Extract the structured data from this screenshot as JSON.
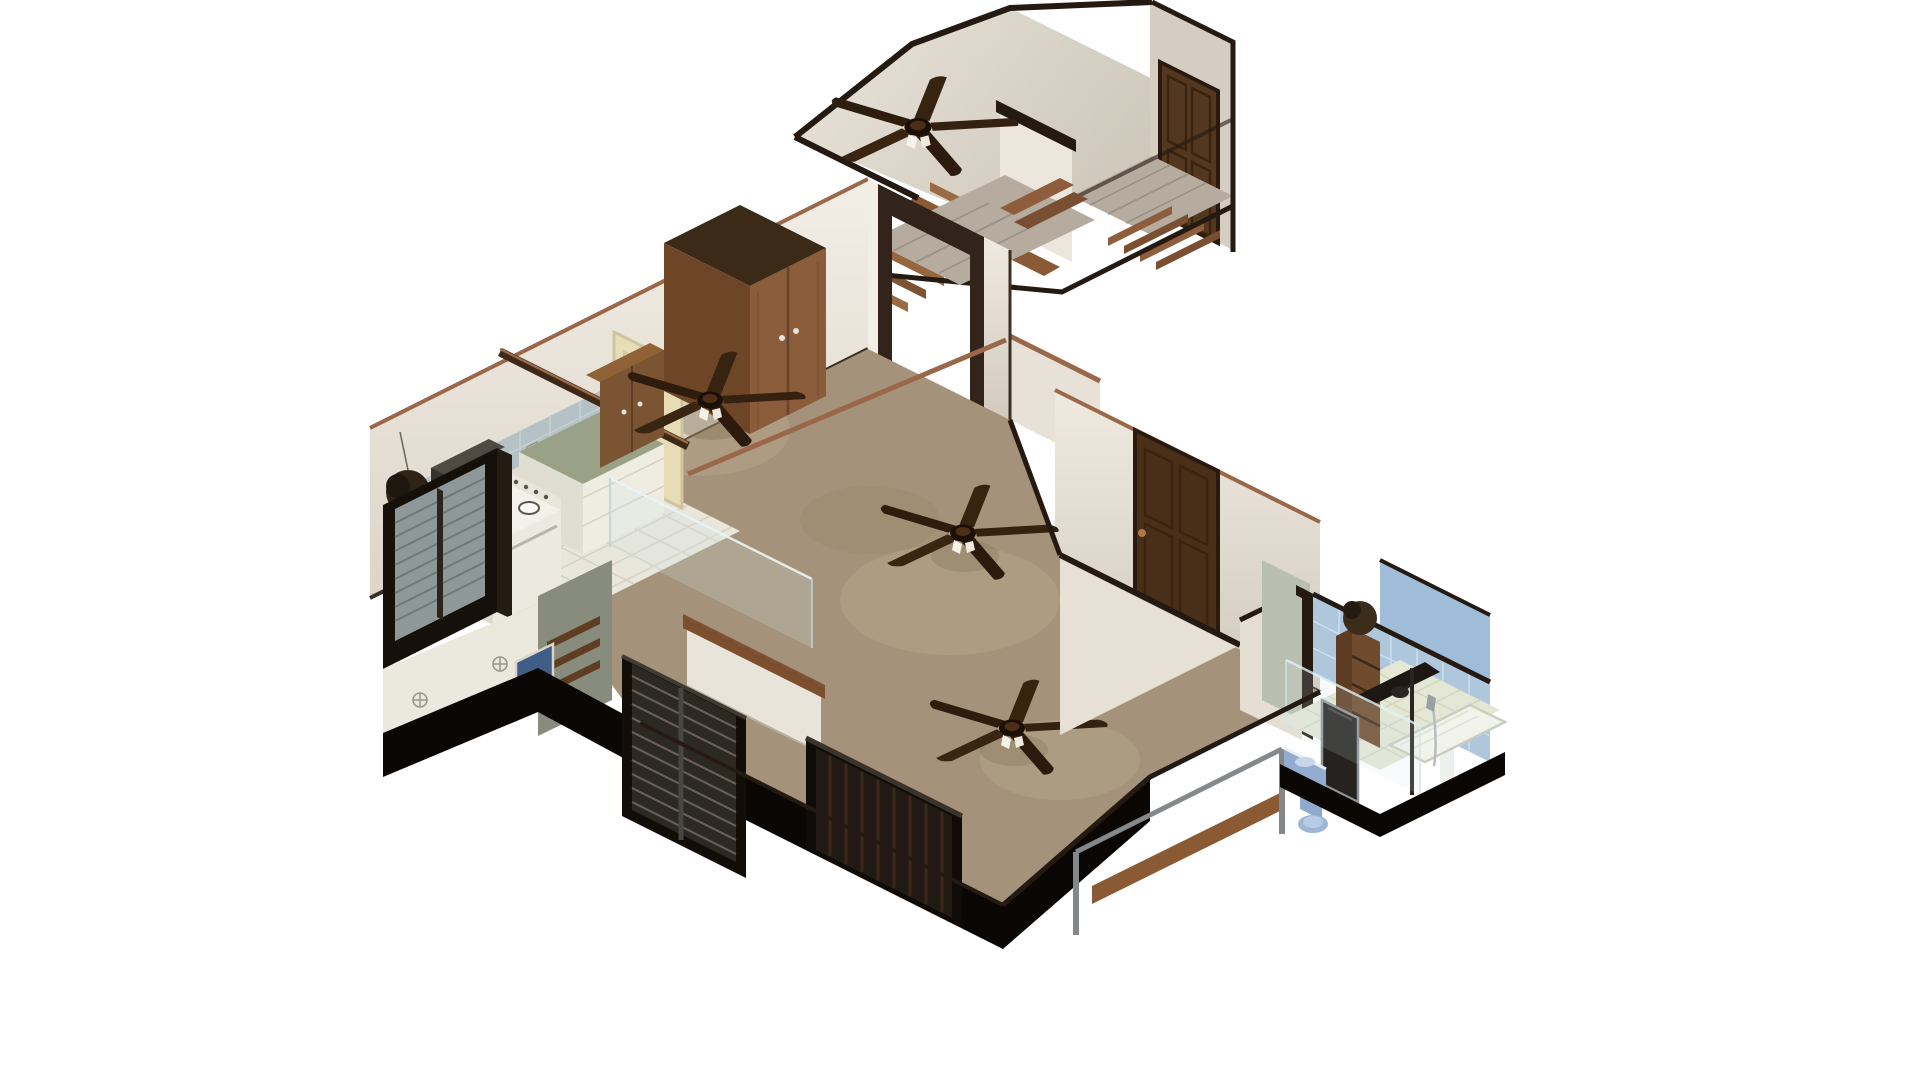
{
  "scene": {
    "type": "isometric-cutaway-3d-floorplan-render",
    "background": "white",
    "rooms": [
      {
        "name": "upper-stair-hall",
        "floor": "light plaster",
        "features": [
          "ceiling-fan",
          "staircase-two-flights",
          "wood-plank-hall",
          "dark-wood-closet-door",
          "dark-cut-wall-trim"
        ]
      },
      {
        "name": "living-room",
        "floor": "tan carpet",
        "features": [
          "ceiling-fan",
          "ceiling-fan",
          "ceiling-fan",
          "entry-doorway",
          "dark-wood-paneled-door",
          "blinds-window",
          "curtain-window",
          "knee-wall-with-wood-cap",
          "copper-wall-cap-rails",
          "balcony-railing-with-bench"
        ]
      },
      {
        "name": "kitchen",
        "floor": "white tile",
        "features": [
          "gas-stove-4-burners",
          "range-hood",
          "sage-green-countertops",
          "blue-tile-backsplash",
          "cream-door",
          "dark-frame-window",
          "hanging-plant",
          "wall-shelves-x3",
          "blue-poster",
          "glass-partition"
        ]
      },
      {
        "name": "wardrobe-nook",
        "floor": "tan carpet",
        "features": [
          "tall-wood-wardrobe",
          "wood-sideboard"
        ]
      },
      {
        "name": "bathroom",
        "floor": "pale tile",
        "features": [
          "blue-tile-walls",
          "blue-toilet",
          "blue-vanity-sink",
          "dark-mirror-panel",
          "shower-with-dark-canopy",
          "wood-shelf-tower-with-plant",
          "glass-screen",
          "white-shower-tray"
        ]
      }
    ],
    "fans": {
      "count": 4,
      "style": "5-blade dark wood ceiling fan with white light kit",
      "positions": [
        "upper-hall",
        "living-room-north",
        "living-room-center",
        "living-room-south"
      ]
    },
    "doors": [
      {
        "name": "upper-closet-door",
        "color": "dark walnut"
      },
      {
        "name": "living-room-side-door",
        "color": "dark walnut",
        "panels": 4,
        "knob": "copper"
      },
      {
        "name": "kitchen-door",
        "color": "cream"
      }
    ],
    "windows": [
      {
        "name": "kitchen-window",
        "frame": "black",
        "glazing": "gray"
      },
      {
        "name": "living-room-blinds-window",
        "frame": "black",
        "covering": "horizontal blinds"
      },
      {
        "name": "living-room-curtain-window",
        "frame": "black",
        "covering": "dark drapes"
      }
    ]
  },
  "palette": {
    "background": "#ffffff",
    "wall": "#ece7df",
    "wallShade": "#d8d1c6",
    "wallBright": "#f2eee6",
    "trim": "#241a12",
    "copper": "#9a6848",
    "carpet": "#a4937a",
    "carpetLight": "#c2b294",
    "kitchenFloor": "#e9e6da",
    "tileGrout": "#d6d2c4",
    "backsplash": "#b4c2c6",
    "counter": "#99a287",
    "woodDark": "#4a2f18",
    "woodMid": "#8a5c3a",
    "woodCabinet": "#7b5434",
    "plankFloor": "#b5ab9e",
    "stairWood": "#9a6a44",
    "cutBlack": "#090604",
    "creamDoor": "#e7dcb6",
    "bathTile": "#aec7dd",
    "bathFloor": "#e3e7d4",
    "fixtureBlue": "#93abce",
    "glass": "#d2e6ef",
    "steel": "#85888a",
    "fanBlade": "#2f1d10",
    "grayGreen": "#878c7c"
  }
}
